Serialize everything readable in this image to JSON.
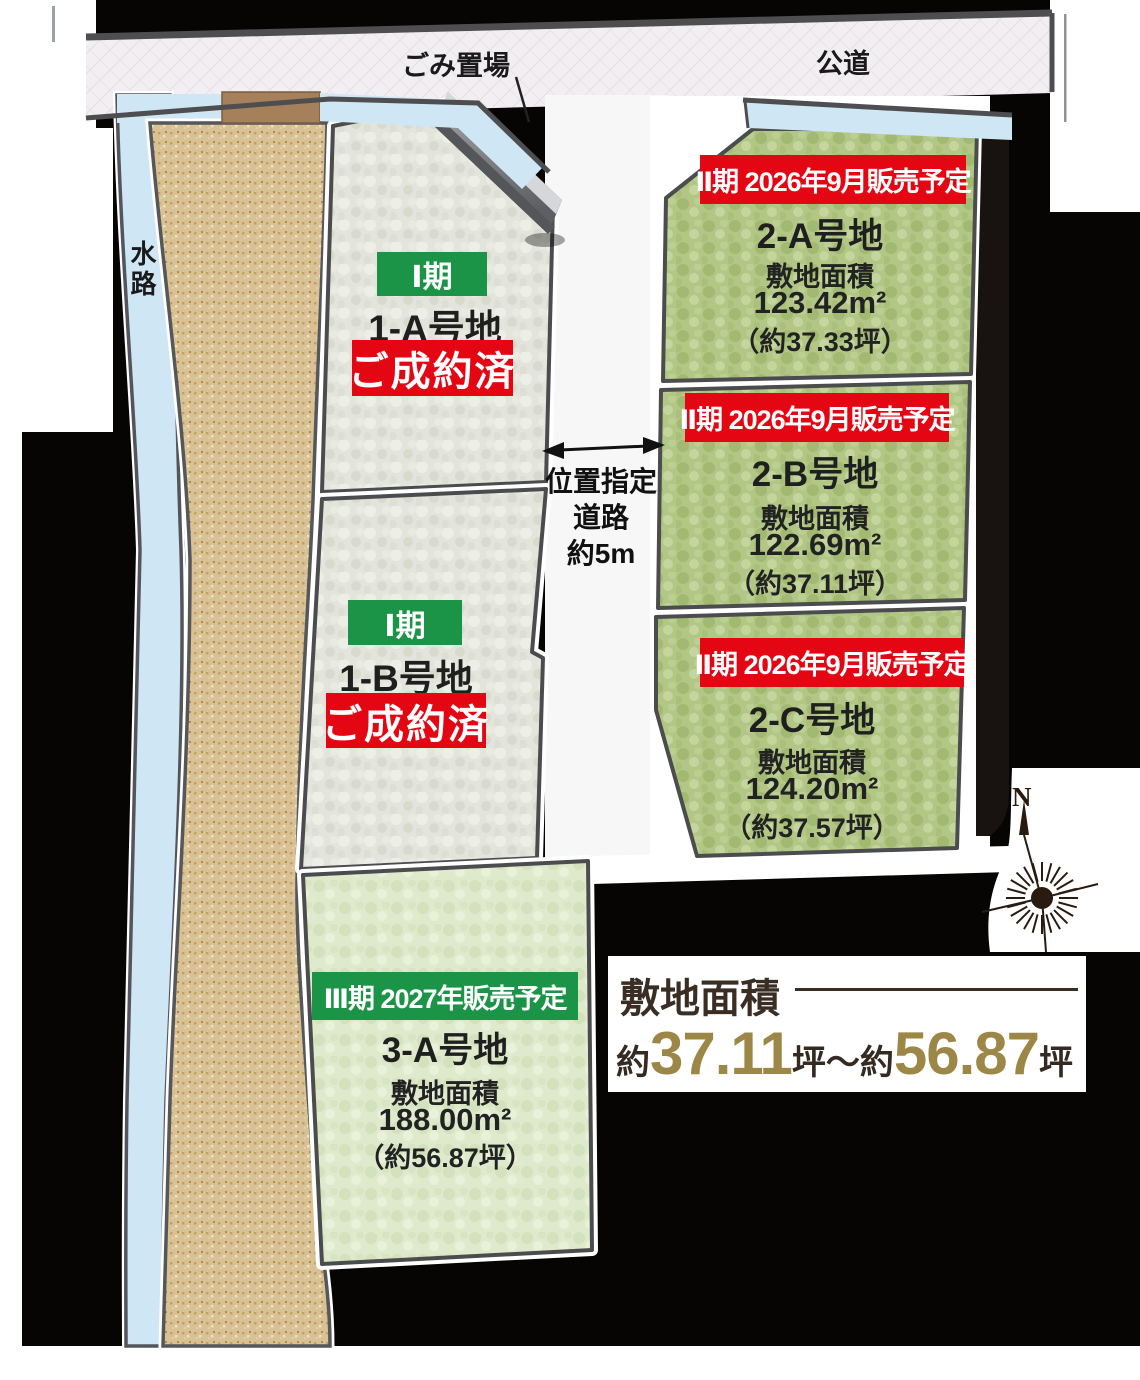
{
  "top": {
    "garbage_label": "ごみ置場",
    "public_road_label": "公道"
  },
  "left": {
    "waterway_label": "水路"
  },
  "center_road": {
    "line1": "位置指定",
    "line2": "道路",
    "line3": "約5m"
  },
  "lots": [
    {
      "id": "1-A",
      "phase_label": "Ⅰ期",
      "name": "1-A号地",
      "status_label": "ご成約済"
    },
    {
      "id": "1-B",
      "phase_label": "Ⅰ期",
      "name": "1-B号地",
      "status_label": "ご成約済"
    },
    {
      "id": "2-A",
      "phase_label": "Ⅱ期 2026年9月販売予定",
      "name": "2-A号地",
      "area_title": "敷地面積",
      "area_value": "123.42m²",
      "area_tsubo": "（約37.33坪）"
    },
    {
      "id": "2-B",
      "phase_label": "Ⅱ期 2026年9月販売予定",
      "name": "2-B号地",
      "area_title": "敷地面積",
      "area_value": "122.69m²",
      "area_tsubo": "（約37.11坪）"
    },
    {
      "id": "2-C",
      "phase_label": "Ⅱ期 2026年9月販売予定",
      "name": "2-C号地",
      "area_title": "敷地面積",
      "area_value": "124.20m²",
      "area_tsubo": "（約37.57坪）"
    },
    {
      "id": "3-A",
      "phase_label": "Ⅲ期 2027年販売予定",
      "name": "3-A号地",
      "area_title": "敷地面積",
      "area_value": "188.00m²",
      "area_tsubo": "（約56.87坪）"
    }
  ],
  "compass": {
    "north_label": "N"
  },
  "summary": {
    "title": "敷地面積",
    "seg_about1": "約",
    "min_value": "37.11",
    "unit1": "坪",
    "tilde": "～",
    "seg_about2": "約",
    "max_value": "56.87",
    "unit2": "坪"
  },
  "colors": {
    "banner_red": "#e50613",
    "banner_green": "#1b9447",
    "gold": "#9c8747",
    "dark_brown": "#352a21",
    "water_blue": "#cfe6f5",
    "lot_green": "#b2c785",
    "lot_pale_green": "#dfeacd",
    "lot_gray": "#e3e4dc",
    "slope_tan": "#d8c194",
    "road_gray": "#f1eff2"
  }
}
